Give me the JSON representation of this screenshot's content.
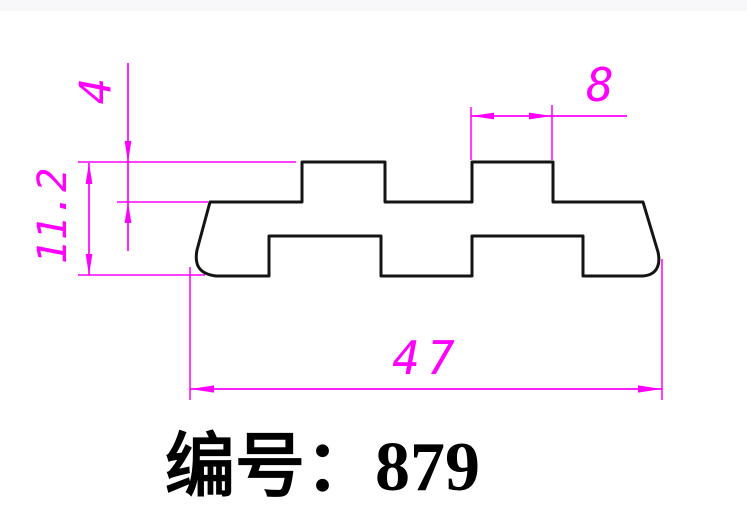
{
  "drawing": {
    "kind": "profile-cross-section",
    "colors": {
      "background": "#ffffff",
      "outline": "#141414",
      "dimension": "#ff00ff",
      "title": "#000000"
    },
    "dimensions": {
      "tab_height": "4",
      "profile_height": "11.2",
      "tab_width": "8",
      "profile_width": "47"
    },
    "title": {
      "text": "编号：879",
      "label_prefix": "编号",
      "part_number": "879"
    }
  }
}
